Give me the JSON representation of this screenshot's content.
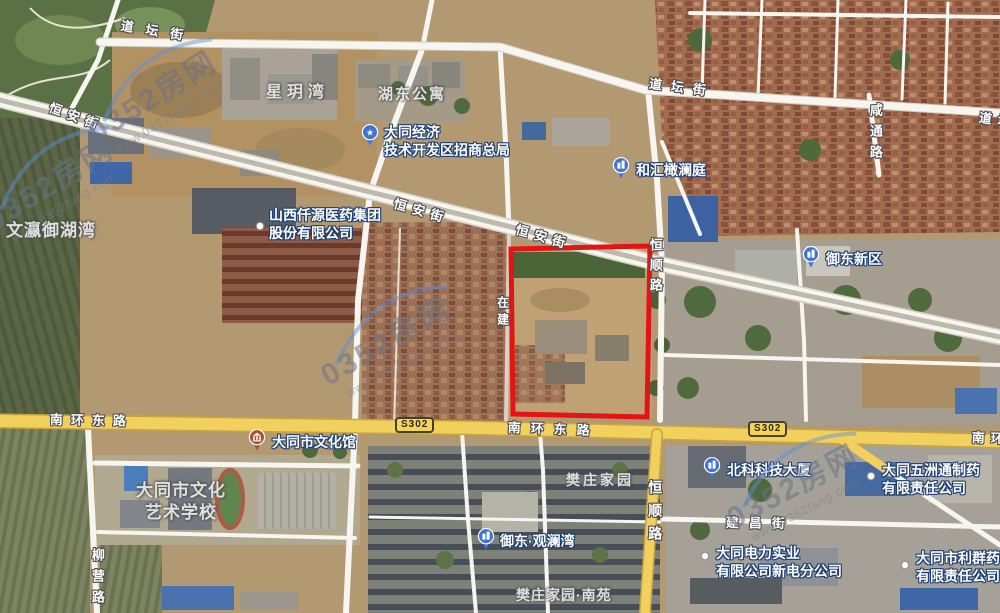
{
  "map": {
    "watermark": {
      "brand": "0352房网",
      "url": "www.0352fang.com",
      "instances": [
        {
          "x": 155,
          "y": 100,
          "rotate": -32
        },
        {
          "x": 52,
          "y": 188,
          "rotate": -32
        },
        {
          "x": 388,
          "y": 345,
          "rotate": -30
        },
        {
          "x": 795,
          "y": 490,
          "rotate": -28
        }
      ]
    },
    "selection": {
      "color": "#e41414",
      "points": [
        [
          511,
          249
        ],
        [
          650,
          246
        ],
        [
          647,
          417
        ],
        [
          513,
          414
        ]
      ]
    },
    "route_badges": [
      {
        "label": "S302",
        "x": 395,
        "y": 417
      },
      {
        "label": "S302",
        "x": 748,
        "y": 421
      }
    ],
    "street_labels": [
      {
        "text": "道坛街",
        "x": 122,
        "y": 18,
        "rotate": 9,
        "spacing": 12,
        "size": 13
      },
      {
        "text": "道坛街",
        "x": 650,
        "y": 76,
        "rotate": 7,
        "spacing": 9,
        "size": 13
      },
      {
        "text": "道坛街",
        "x": 980,
        "y": 110,
        "rotate": 8,
        "spacing": 6,
        "size": 13
      },
      {
        "text": "恒安街",
        "x": 52,
        "y": 100,
        "rotate": 20,
        "spacing": 6,
        "size": 13
      },
      {
        "text": "恒安街",
        "x": 396,
        "y": 196,
        "rotate": 16,
        "spacing": 6,
        "size": 13
      },
      {
        "text": "恒安街",
        "x": 518,
        "y": 222,
        "rotate": 16,
        "spacing": 6,
        "size": 13
      },
      {
        "text": "恒顺路",
        "x": 646,
        "y": 238,
        "vertical": true,
        "spacing": 7,
        "size": 13
      },
      {
        "text": "恒顺路",
        "x": 646,
        "y": 480,
        "vertical": true,
        "spacing": 9,
        "size": 14
      },
      {
        "text": "南环东路",
        "x": 50,
        "y": 412,
        "rotate": 1,
        "spacing": 8,
        "size": 13
      },
      {
        "text": "南环东路",
        "x": 508,
        "y": 420,
        "rotate": 2,
        "spacing": 10,
        "size": 13
      },
      {
        "text": "南环东路",
        "x": 972,
        "y": 430,
        "rotate": 2,
        "spacing": 6,
        "size": 13
      },
      {
        "text": "建昌街",
        "x": 726,
        "y": 515,
        "rotate": 1,
        "spacing": 10,
        "size": 13
      },
      {
        "text": "柳营路",
        "x": 88,
        "y": 548,
        "vertical": true,
        "spacing": 8,
        "size": 13
      },
      {
        "text": "咸通路",
        "x": 866,
        "y": 103,
        "vertical": true,
        "spacing": 8,
        "size": 13
      },
      {
        "text": "在建",
        "x": 494,
        "y": 296,
        "vertical": true,
        "spacing": 5,
        "size": 12
      }
    ],
    "area_labels": [
      {
        "lines": [
          "星玥湾"
        ],
        "x": 266,
        "y": 83,
        "size": 16,
        "spacing": 5
      },
      {
        "lines": [
          "湖东公寓"
        ],
        "x": 378,
        "y": 85,
        "size": 15,
        "spacing": 2
      },
      {
        "lines": [
          "文瀛御湖湾"
        ],
        "x": 6,
        "y": 220,
        "size": 17,
        "spacing": 1
      },
      {
        "lines": [
          "大同市文化",
          "艺术学校"
        ],
        "x": 136,
        "y": 480,
        "size": 17,
        "spacing": 1,
        "center": true
      },
      {
        "lines": [
          "樊庄家园"
        ],
        "x": 566,
        "y": 471,
        "size": 14,
        "spacing": 3
      },
      {
        "lines": [
          "樊庄家园·南苑"
        ],
        "x": 516,
        "y": 586,
        "size": 14,
        "spacing": 1
      }
    ],
    "poi_labels": [
      {
        "lines": [
          "大同经济",
          "技术开发区招商总局"
        ],
        "icon": "star-pin",
        "ix": 370,
        "iy": 137,
        "tx": 384,
        "ty": 123
      },
      {
        "lines": [
          "和汇橄澜庭"
        ],
        "icon": "building-pin",
        "ix": 621,
        "iy": 170,
        "tx": 636,
        "ty": 161
      },
      {
        "lines": [
          "御东新区"
        ],
        "icon": "building-pin",
        "ix": 811,
        "iy": 259,
        "tx": 826,
        "ty": 250
      },
      {
        "lines": [
          "山西仟源医药集团",
          "股份有限公司"
        ],
        "icon": "dot-marker",
        "ix": 260,
        "iy": 227,
        "tx": 269,
        "ty": 206
      },
      {
        "lines": [
          "大同市文化馆"
        ],
        "icon": "museum-pin",
        "ix": 257,
        "iy": 442,
        "tx": 272,
        "ty": 433
      },
      {
        "lines": [
          "北科科技大厦"
        ],
        "icon": "building-pin",
        "ix": 712,
        "iy": 470,
        "tx": 727,
        "ty": 461
      },
      {
        "lines": [
          "大同五洲通制药",
          "有限责任公司"
        ],
        "icon": "dot-marker",
        "ix": 871,
        "iy": 477,
        "tx": 882,
        "ty": 461
      },
      {
        "lines": [
          "御东·观澜湾"
        ],
        "icon": "building-pin",
        "ix": 486,
        "iy": 541,
        "tx": 500,
        "ty": 532
      },
      {
        "lines": [
          "大同电力实业",
          "有限公司新电分公司"
        ],
        "icon": "dot-marker",
        "ix": 705,
        "iy": 557,
        "tx": 716,
        "ty": 544
      },
      {
        "lines": [
          "大同市利群药",
          "有限责任公司"
        ],
        "icon": "dot-marker",
        "ix": 905,
        "iy": 566,
        "tx": 916,
        "ty": 549
      }
    ],
    "colors": {
      "poi_pin_blue": "#3f74d6",
      "museum_pin_red": "#a8502f",
      "highway_yellow": "#f2d05e",
      "road_white": "#f7f5ef"
    }
  }
}
